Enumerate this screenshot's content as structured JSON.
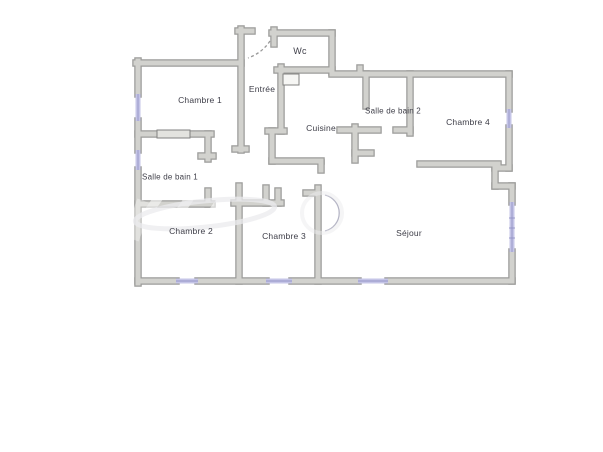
{
  "document": {
    "type": "floor-plan",
    "background": "#ffffff"
  },
  "colors": {
    "wall_fill": "#d2d2ce",
    "wall_edge": "#9c9c9a",
    "window": "#c5c5e7",
    "window_core": "#9494c4",
    "label_text": "#3e3e48",
    "door_dash": "#999999"
  },
  "rooms": {
    "wc": {
      "label": "Wc"
    },
    "entree": {
      "label": "Entrée"
    },
    "chambre1": {
      "label": "Chambre 1"
    },
    "cuisine": {
      "label": "Cuisine"
    },
    "salle_de_bain_2": {
      "label": "Salle de bain 2"
    },
    "chambre4": {
      "label": "Chambre 4"
    },
    "salle_de_bain_1": {
      "label": "Salle de bain 1"
    },
    "chambre2": {
      "label": "Chambre 2"
    },
    "chambre3": {
      "label": "Chambre 3"
    },
    "sejour": {
      "label": "Séjour"
    }
  }
}
